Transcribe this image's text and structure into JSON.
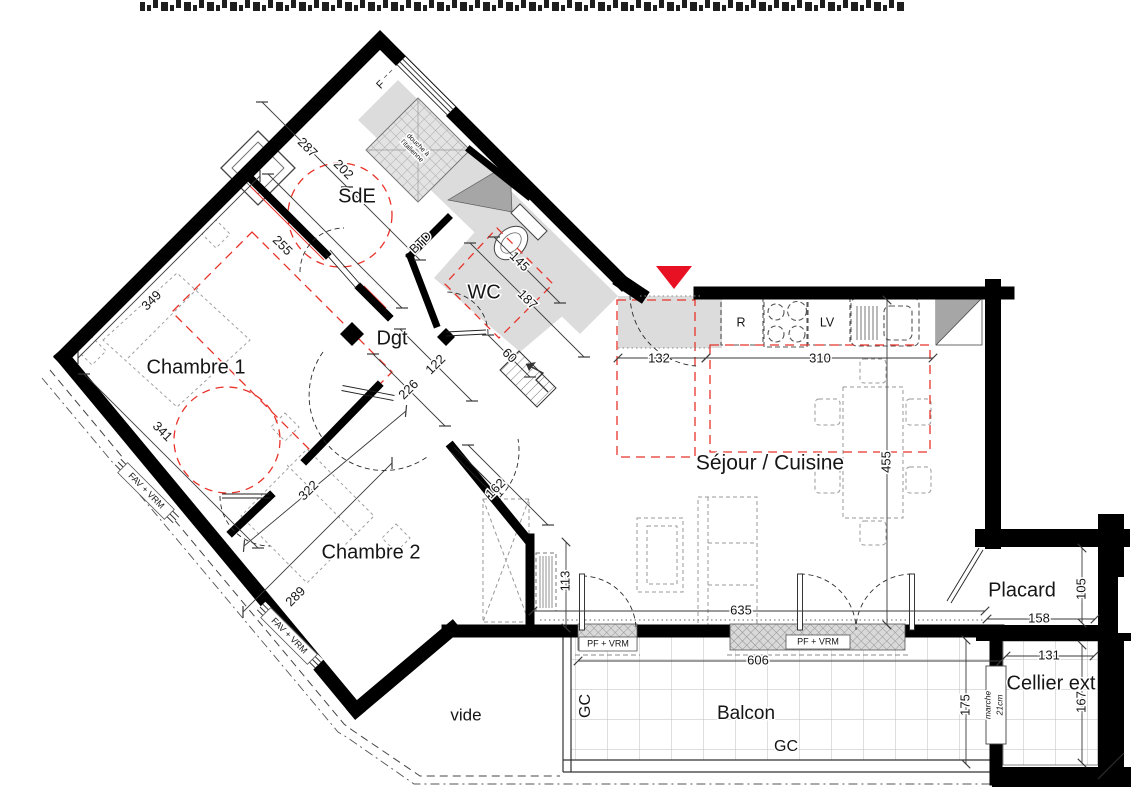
{
  "plan": {
    "type": "architectural-floor-plan",
    "rooms": [
      {
        "id": "sde",
        "label": "SdE",
        "x": 357,
        "y": 197,
        "fs": 20
      },
      {
        "id": "wc",
        "label": "WC",
        "x": 484,
        "y": 293,
        "fs": 20
      },
      {
        "id": "dgt",
        "label": "Dgt",
        "x": 392,
        "y": 339,
        "fs": 20
      },
      {
        "id": "chambre-1",
        "label": "Chambre 1",
        "x": 196,
        "y": 368,
        "fs": 20
      },
      {
        "id": "chambre-2",
        "label": "Chambre 2",
        "x": 371,
        "y": 553,
        "fs": 20
      },
      {
        "id": "sejour-cuisine",
        "label": "Séjour / Cuisine",
        "x": 770,
        "y": 464,
        "fs": 21
      },
      {
        "id": "placard",
        "label": "Placard",
        "x": 1022,
        "y": 591,
        "fs": 20
      },
      {
        "id": "cellier-ext",
        "label": "Cellier ext",
        "x": 1051,
        "y": 684,
        "fs": 20
      },
      {
        "id": "balcon",
        "label": "Balcon",
        "x": 746,
        "y": 714,
        "fs": 19
      },
      {
        "id": "vide",
        "label": "vide",
        "x": 466,
        "y": 716,
        "fs": 17,
        "color": "#4a4a4a"
      }
    ],
    "dimensions_cm": [
      {
        "label": "287",
        "x": 307,
        "y": 148,
        "r": 45
      },
      {
        "label": "202",
        "x": 343,
        "y": 170,
        "r": 45
      },
      {
        "label": "255",
        "x": 282,
        "y": 246,
        "r": 45
      },
      {
        "label": "349",
        "x": 152,
        "y": 301,
        "r": -45
      },
      {
        "label": "341",
        "x": 162,
        "y": 432,
        "r": 45
      },
      {
        "label": "322",
        "x": 309,
        "y": 491,
        "r": -45
      },
      {
        "label": "289",
        "x": 296,
        "y": 597,
        "r": -45
      },
      {
        "label": "145",
        "x": 519,
        "y": 262,
        "r": 45
      },
      {
        "label": "187",
        "x": 527,
        "y": 300,
        "r": 45
      },
      {
        "label": "60",
        "x": 509,
        "y": 356,
        "r": 45
      },
      {
        "label": "122",
        "x": 436,
        "y": 365,
        "r": -45
      },
      {
        "label": "226",
        "x": 409,
        "y": 390,
        "r": -45
      },
      {
        "label": "162",
        "x": 496,
        "y": 489,
        "r": -45
      },
      {
        "label": "113",
        "x": 566,
        "y": 581,
        "r": -90
      },
      {
        "label": "132",
        "x": 659,
        "y": 359,
        "r": 0
      },
      {
        "label": "310",
        "x": 820,
        "y": 359,
        "r": 0
      },
      {
        "label": "455",
        "x": 887,
        "y": 462,
        "r": -90
      },
      {
        "label": "635",
        "x": 741,
        "y": 611,
        "r": 0
      },
      {
        "label": "606",
        "x": 758,
        "y": 661,
        "r": 0
      },
      {
        "label": "158",
        "x": 1039,
        "y": 619,
        "r": 0
      },
      {
        "label": "105",
        "x": 1082,
        "y": 589,
        "r": -90
      },
      {
        "label": "131",
        "x": 1049,
        "y": 656,
        "r": 0
      },
      {
        "label": "167",
        "x": 1082,
        "y": 702,
        "r": -90
      },
      {
        "label": "175",
        "x": 966,
        "y": 705,
        "r": -90
      }
    ],
    "annotations": [
      {
        "id": "btd-label",
        "label": "BTD",
        "x": 421,
        "y": 243,
        "fs": 12.5,
        "r": -45
      },
      {
        "id": "fridge-label",
        "label": "R",
        "x": 741,
        "y": 323,
        "fs": 12.5,
        "r": 0
      },
      {
        "id": "dishwasher-label",
        "label": "LV",
        "x": 827,
        "y": 323,
        "fs": 12.5,
        "r": 0
      },
      {
        "id": "window-f-label",
        "label": "F",
        "x": 381,
        "y": 85,
        "fs": 11,
        "r": -45
      },
      {
        "id": "gc-left-label",
        "label": "GC",
        "x": 586,
        "y": 706,
        "fs": 16,
        "r": -90
      },
      {
        "id": "gc-bottom-label",
        "label": "GC",
        "x": 786,
        "y": 747,
        "fs": 16,
        "r": 0
      },
      {
        "id": "shower-label-1",
        "label": "douche à",
        "x": 418,
        "y": 145,
        "fs": 7,
        "r": 45
      },
      {
        "id": "shower-label-2",
        "label": "l'italienne",
        "x": 412,
        "y": 151,
        "fs": 7,
        "r": 45
      },
      {
        "id": "step-label",
        "label": "marche",
        "x": 988,
        "y": 705,
        "fs": 8.5,
        "r": -90,
        "i": 1
      },
      {
        "id": "step-height-label",
        "label": "21cm",
        "x": 1000,
        "y": 705,
        "fs": 8.5,
        "r": -90,
        "i": 1
      }
    ],
    "window_labels": [
      {
        "id": "window-fav-1",
        "label": "FAV + VRM",
        "x": 146,
        "y": 491,
        "r": 45,
        "w": 66
      },
      {
        "id": "window-fav-2",
        "label": "FAV + VRM",
        "x": 289,
        "y": 636,
        "r": 45,
        "w": 66
      },
      {
        "id": "window-pf-1",
        "label": "PF + VRM",
        "x": 608,
        "y": 644,
        "r": 0,
        "w": 58
      },
      {
        "id": "window-pf-2",
        "label": "PF + VRM",
        "x": 818,
        "y": 642,
        "r": 0,
        "w": 64
      }
    ],
    "colors": {
      "wall": "#000000",
      "entrance_marker_red": "#e81123",
      "guide_red": "#e8332a",
      "floor_gray": "#dcdcdc",
      "shaft_gray": "#a6a6a6",
      "furniture_gray": "#999999"
    }
  }
}
